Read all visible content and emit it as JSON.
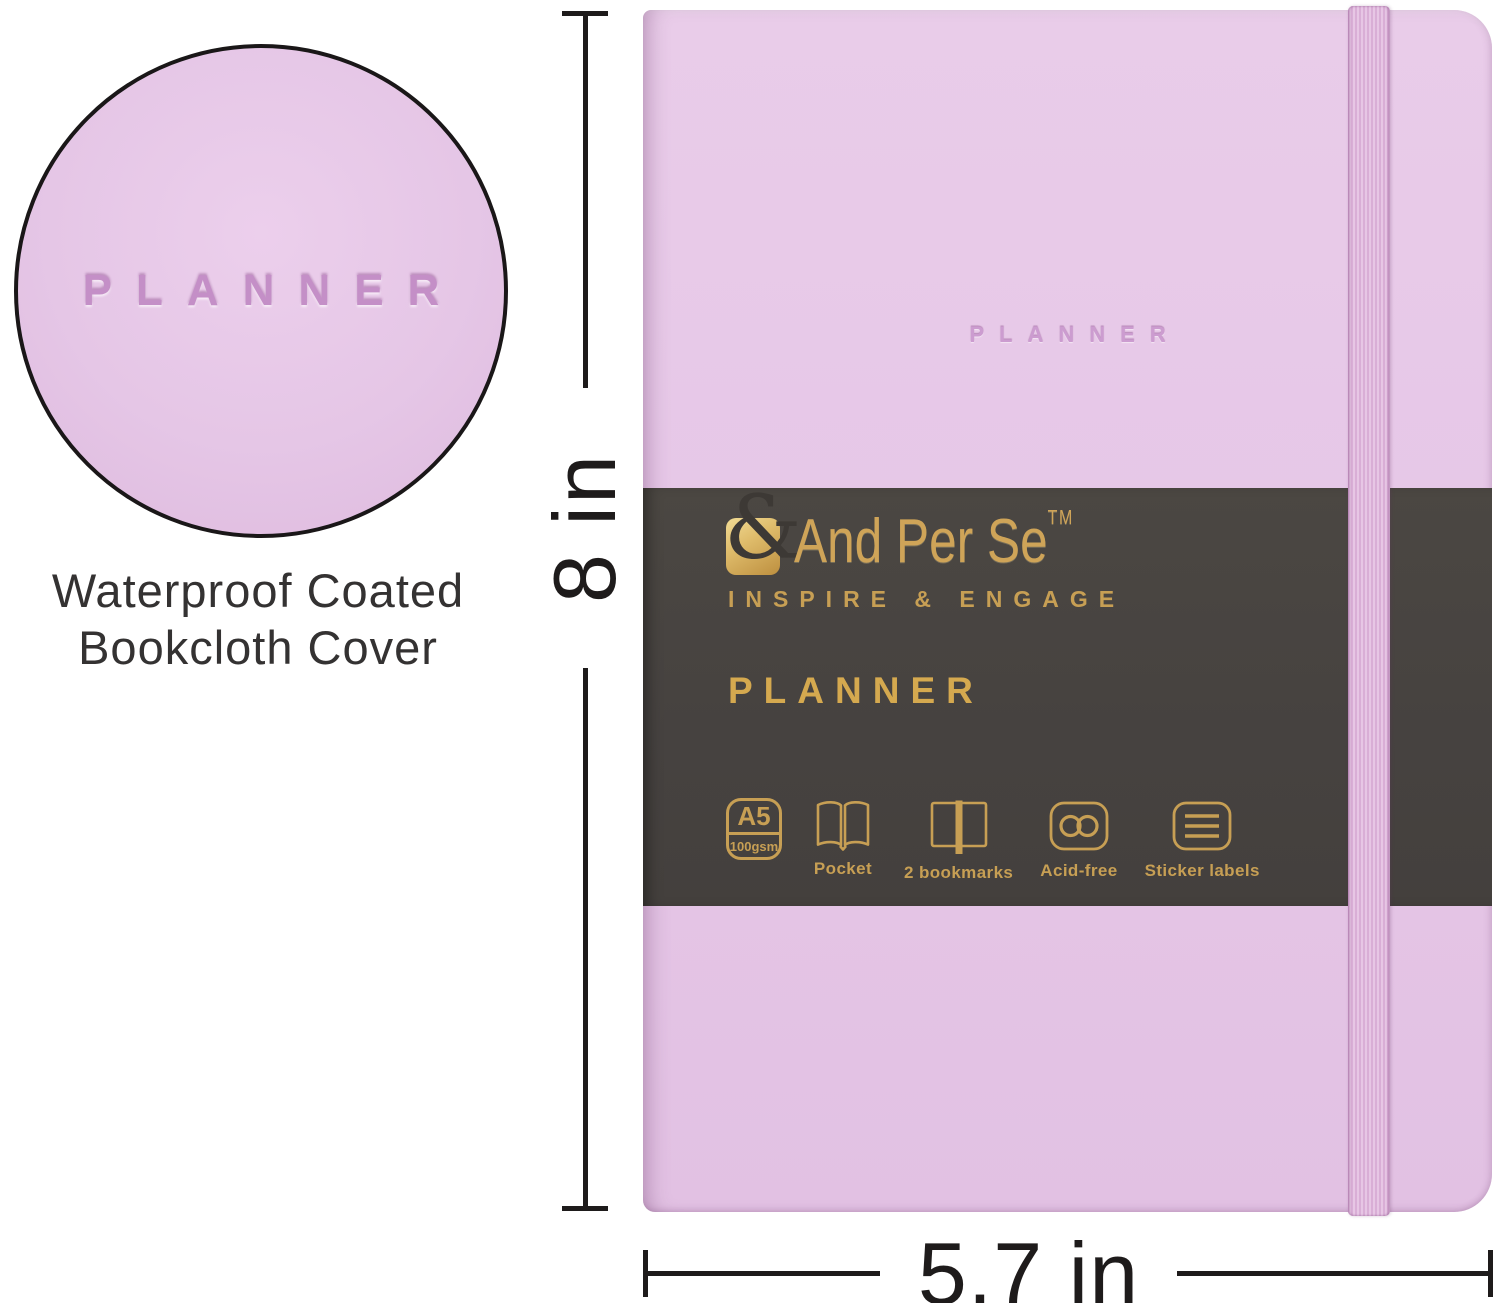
{
  "detail": {
    "embossed_text": "PLANNER",
    "caption_line1": "Waterproof Coated",
    "caption_line2": "Bookcloth Cover"
  },
  "planner": {
    "cover_embossed_text": "PLANNER"
  },
  "band": {
    "ampersand": "&",
    "brand_name": "And Per Se",
    "trademark": "TM",
    "tagline": "INSPIRE & ENGAGE",
    "product_title": "PLANNER",
    "features": [
      {
        "icon": "a5-size-badge",
        "badge_top": "A5",
        "badge_bottom": "100gsm",
        "label": ""
      },
      {
        "icon": "pocket-icon",
        "label": "Pocket"
      },
      {
        "icon": "bookmarks-icon",
        "label": "2 bookmarks"
      },
      {
        "icon": "acid-free-icon",
        "label": "Acid-free"
      },
      {
        "icon": "sticker-labels-icon",
        "label": "Sticker labels"
      }
    ]
  },
  "dimensions": {
    "height_label": "8 in",
    "width_label": "5.7 in"
  },
  "colors": {
    "cover_lilac": "#e6c7e7",
    "belly_band": "#464240",
    "gold": "#c79f54",
    "elastic_pink": "#d2a2cf",
    "dimension_line": "#1e1b1b"
  }
}
